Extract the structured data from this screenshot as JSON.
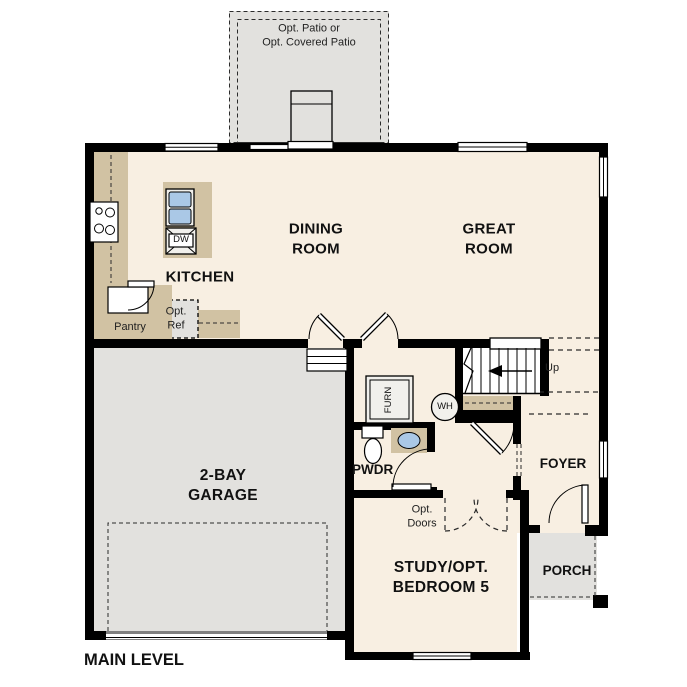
{
  "plan": {
    "level_title": "MAIN LEVEL",
    "rooms": {
      "patio": "Opt. Patio or\nOpt. Covered Patio",
      "dining": "DINING\nROOM",
      "great": "GREAT\nROOM",
      "kitchen": "KITCHEN",
      "pantry": "Pantry",
      "garage": "2-BAY\nGARAGE",
      "study": "STUDY/OPT.\nBEDROOM 5",
      "foyer": "FOYER",
      "porch": "PORCH",
      "pwdr": "PWDR"
    },
    "annotations": {
      "opt_ref": "Opt.\nRef",
      "opt_doors": "Opt.\nDoors",
      "up": "Up",
      "dw": "DW",
      "wh": "WH",
      "furn": "FURN"
    },
    "colors": {
      "floor": "#f8efe2",
      "concrete": "#e2e1de",
      "cabinet": "#d1c2a3",
      "sink_blue": "#aac8e6",
      "wall": "#000000"
    }
  }
}
